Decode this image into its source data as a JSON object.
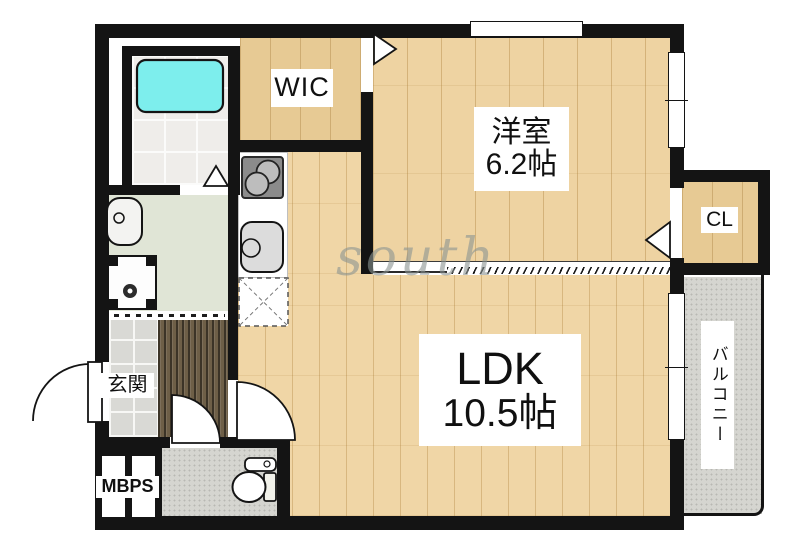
{
  "rooms": {
    "wic": {
      "label": "WIC"
    },
    "western_room": {
      "name": "洋室",
      "size": "6.2帖"
    },
    "closet": {
      "label": "CL"
    },
    "ldk": {
      "name": "LDK",
      "size": "10.5帖"
    },
    "balcony": {
      "label": "バルコニー"
    },
    "entrance": {
      "label": "玄関"
    },
    "meter_box": {
      "label": "MBPS"
    }
  },
  "watermark": {
    "text": "south",
    "color": "#8b9492"
  },
  "colors": {
    "wall": "#141414",
    "wood_floor": "#eed3a2",
    "wic_floor": "#e7ca94",
    "hall_floor": "#6e5f47",
    "entrance_tile": "#d9d9d5",
    "bath_tile": "#efedea",
    "bathtub": "#7deeed",
    "washroom_floor": "#e0e5d6",
    "balcony_concrete": "#d5d5d0"
  },
  "fixtures": [
    "bathtub",
    "stove-burners",
    "kitchen-sink",
    "refrigerator-space",
    "washbasin",
    "washing-machine-space",
    "toilet",
    "door-swings",
    "windows"
  ]
}
